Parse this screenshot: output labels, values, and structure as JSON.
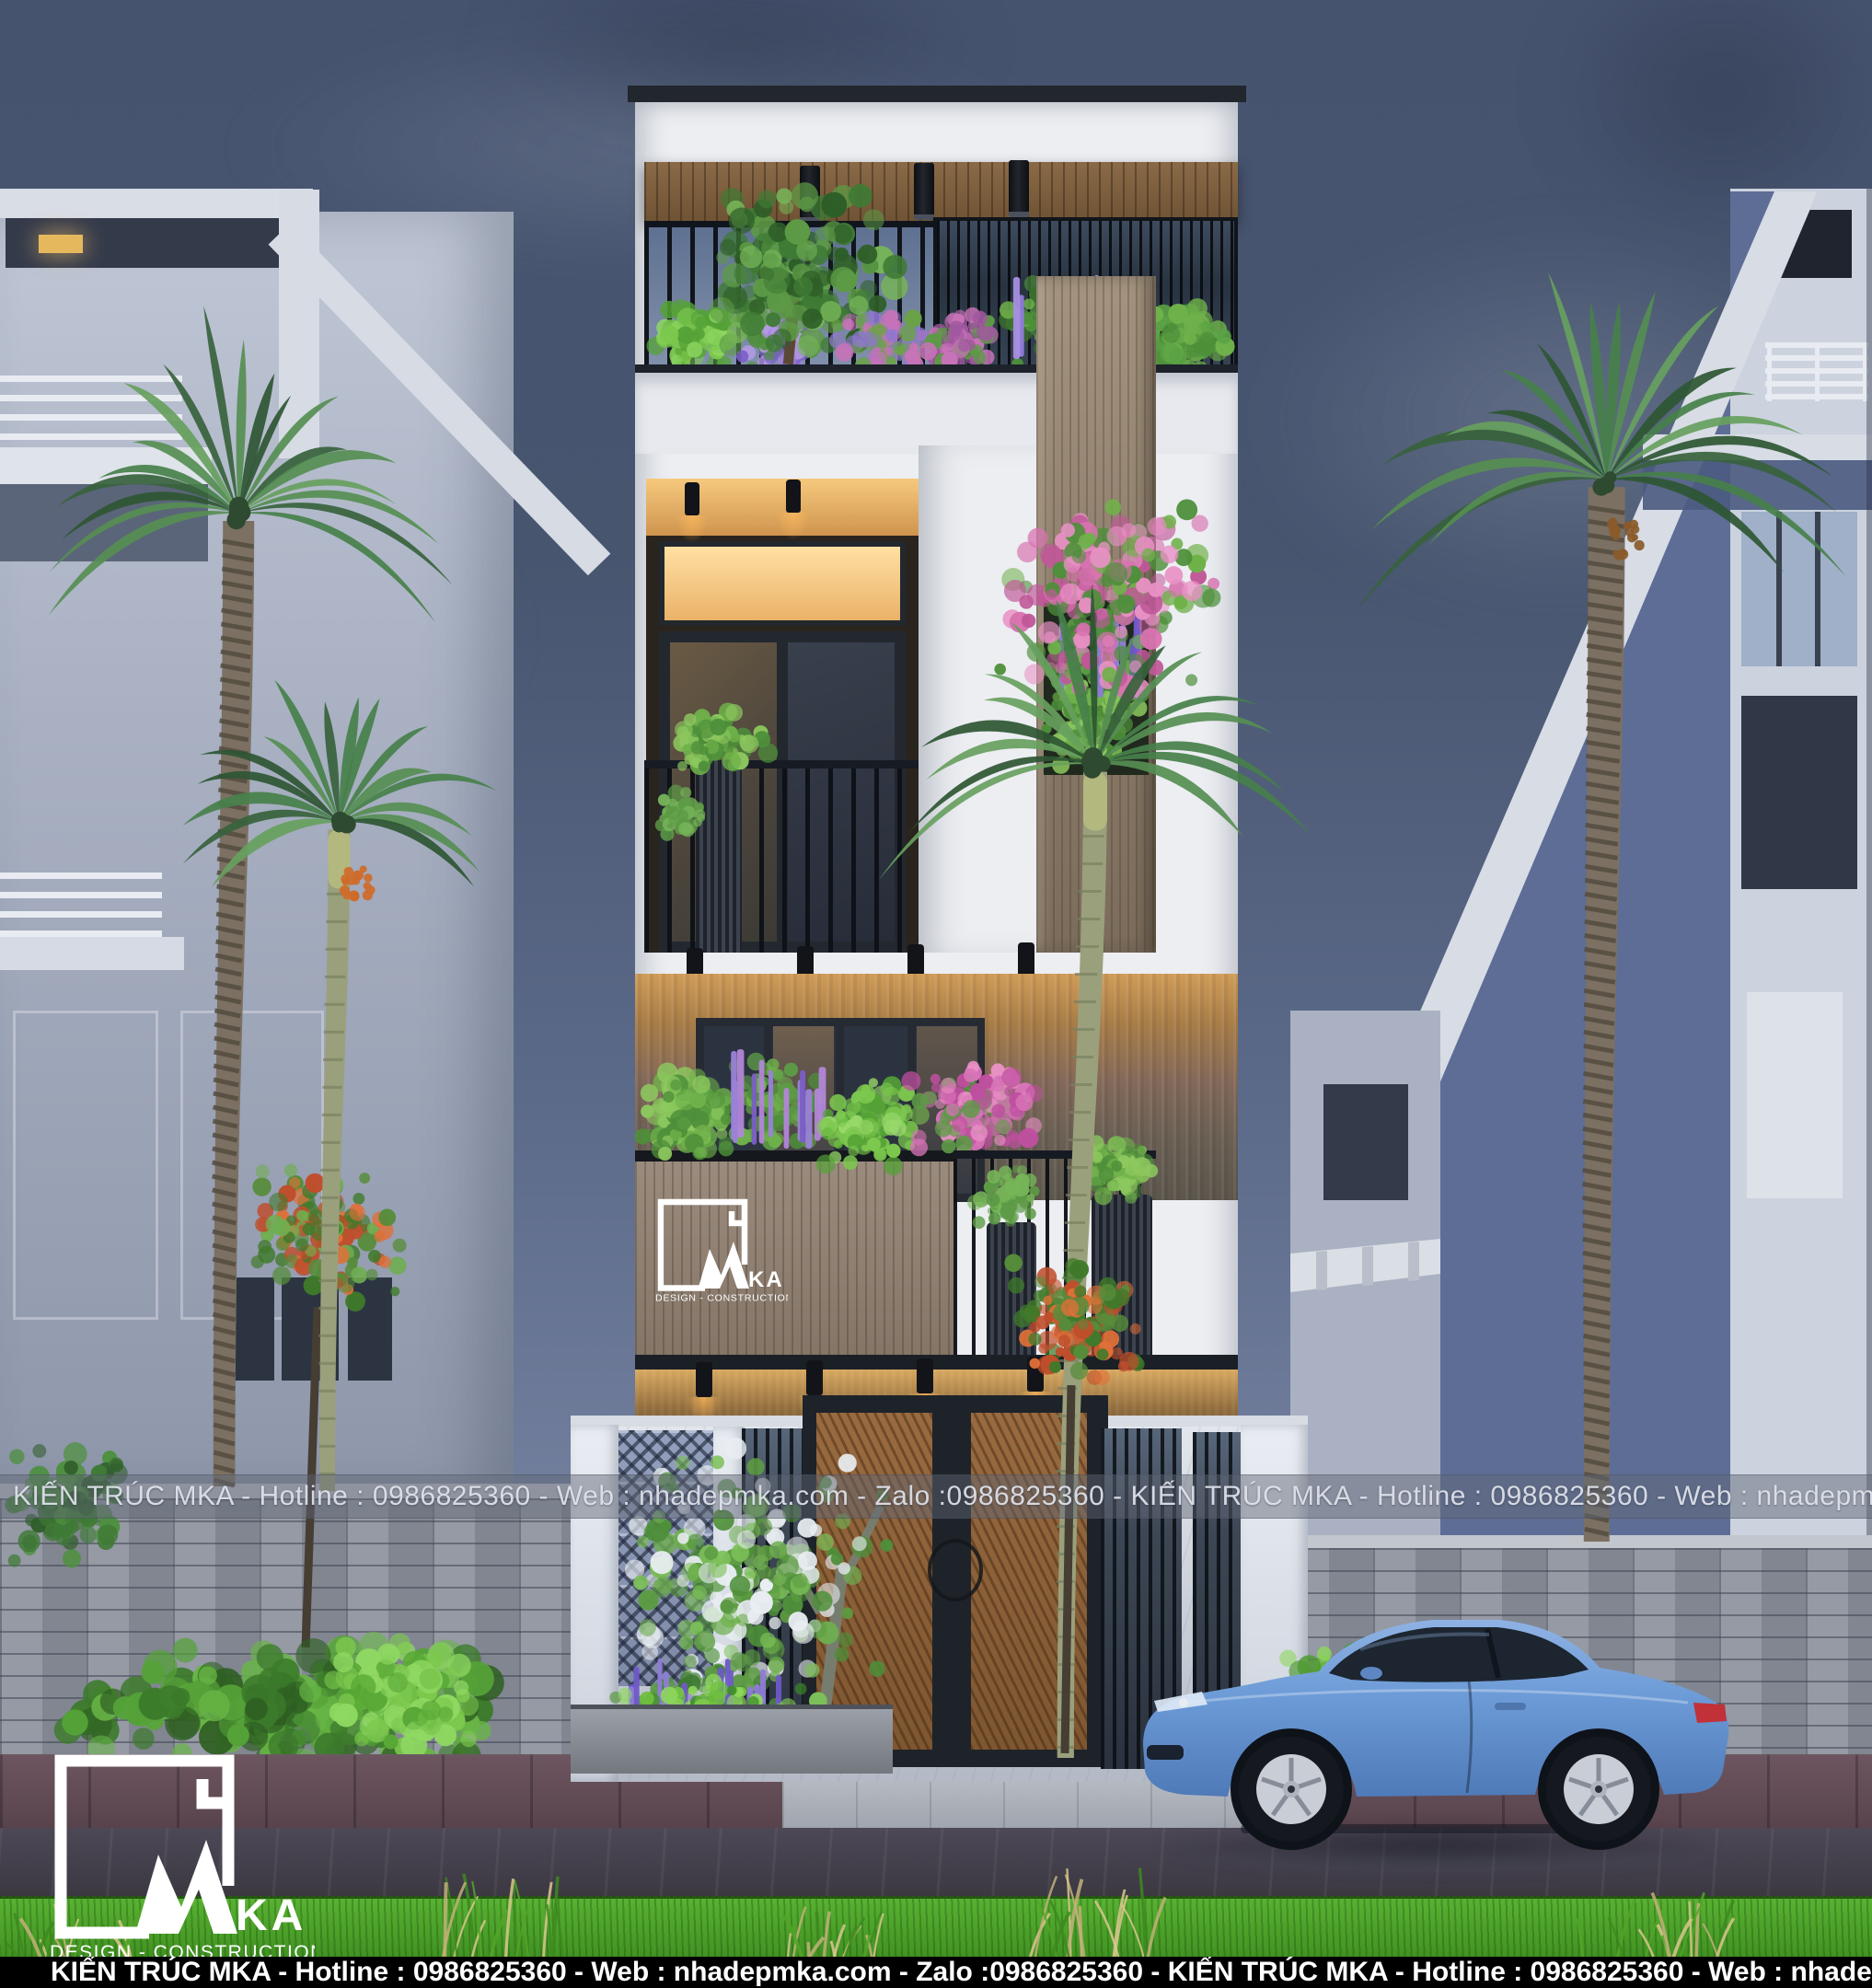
{
  "watermark": {
    "text": "KIẾN TRÚC MKA - Hotline : 0986825360 - Web : nhadepmka.com - Zalo :0986825360 - KIẾN TRÚC MKA - Hotline : 0986825360 - Web : nhadepm-"
  },
  "footer_bar": {
    "text": "KIẾN TRÚC MKA - Hotline : 0986825360 - Web : nhadepmka.com - Zalo :0986825360 - KIẾN TRÚC MKA - Hotline : 0986825360 - Web : nhadepm-"
  },
  "logo": {
    "letters_ka": "KA",
    "tagline": "DESIGN - CONSTRUCTION"
  },
  "colors": {
    "sky": "#4d5b7c",
    "facade_white": "#eceef2",
    "timber": "#8d7f72",
    "warm_light": "#e8a95a",
    "foliage_green": "#4e8f3a",
    "flower_purple": "#8f7bd8",
    "flower_pink": "#d873b0",
    "car_blue": "#6b9ad6",
    "grass_green": "#4aa42a",
    "road": "#413e4a",
    "brick_wall": "#949aa4",
    "footer_bar_bg": "#000000"
  }
}
